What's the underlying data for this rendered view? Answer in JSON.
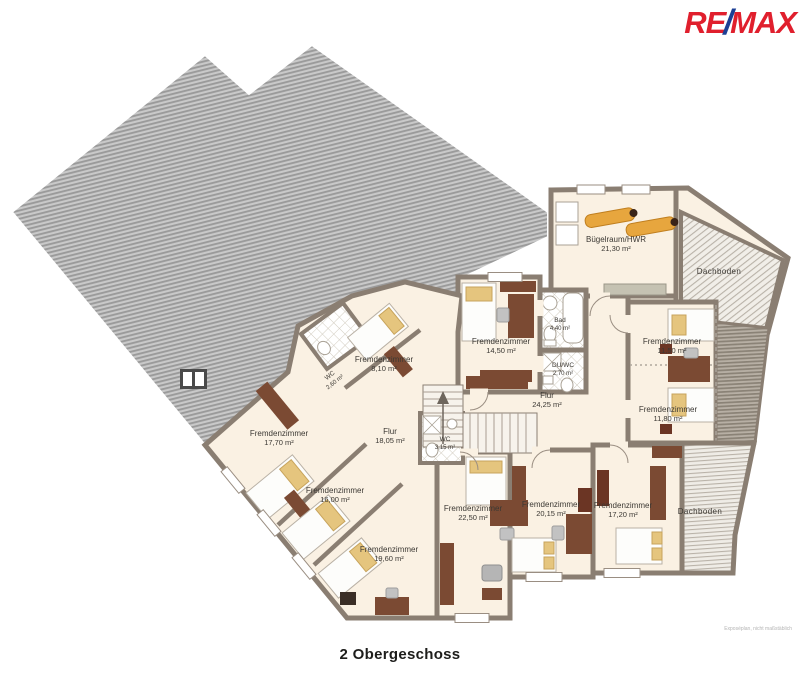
{
  "brand": {
    "re": "RE",
    "slash": "/",
    "max": "MAX",
    "red": "#E01F2D",
    "blue": "#1C3F94"
  },
  "title": "2 Obergeschoss",
  "disclaimer": "Exposéplan, nicht maßstäblich",
  "colors": {
    "wall": "#8a7e72",
    "floor": "#faf1e3",
    "roof_stripe": "#9a9a9a",
    "attic_line": "#b9b2a8",
    "wood": "#7b4a33",
    "pillow": "#e5c57e"
  },
  "rooms": [
    {
      "name": "Bügelraum/HWR",
      "area": "21,30 m²"
    },
    {
      "name": "Dachboden",
      "area": ""
    },
    {
      "name": "Fremdenzimmer",
      "area": "14,50 m²"
    },
    {
      "name": "Bad",
      "area": "4,40 m²"
    },
    {
      "name": "DU/WC",
      "area": "2,70 m²"
    },
    {
      "name": "Flur",
      "area": "24,25 m²"
    },
    {
      "name": "Fremdenzimmer",
      "area": "11,50 m²"
    },
    {
      "name": "Fremdenzimmer",
      "area": "11,80 m²"
    },
    {
      "name": "Fremdenzimmer",
      "area": "8,10 m²"
    },
    {
      "name": "WC",
      "area": "2,60 m²"
    },
    {
      "name": "Flur",
      "area": "18,05 m²"
    },
    {
      "name": "WC",
      "area": "3,15 m²"
    },
    {
      "name": "Fremdenzimmer",
      "area": "17,70 m²"
    },
    {
      "name": "Fremdenzimmer",
      "area": "16,00 m²"
    },
    {
      "name": "Fremdenzimmer",
      "area": "19,60 m²"
    },
    {
      "name": "Fremdenzimmer",
      "area": "22,50 m²"
    },
    {
      "name": "Fremdenzimmer",
      "area": "20,15 m²"
    },
    {
      "name": "Fremdenzimmer",
      "area": "17,20 m²"
    },
    {
      "name": "Dachboden",
      "area": ""
    }
  ]
}
